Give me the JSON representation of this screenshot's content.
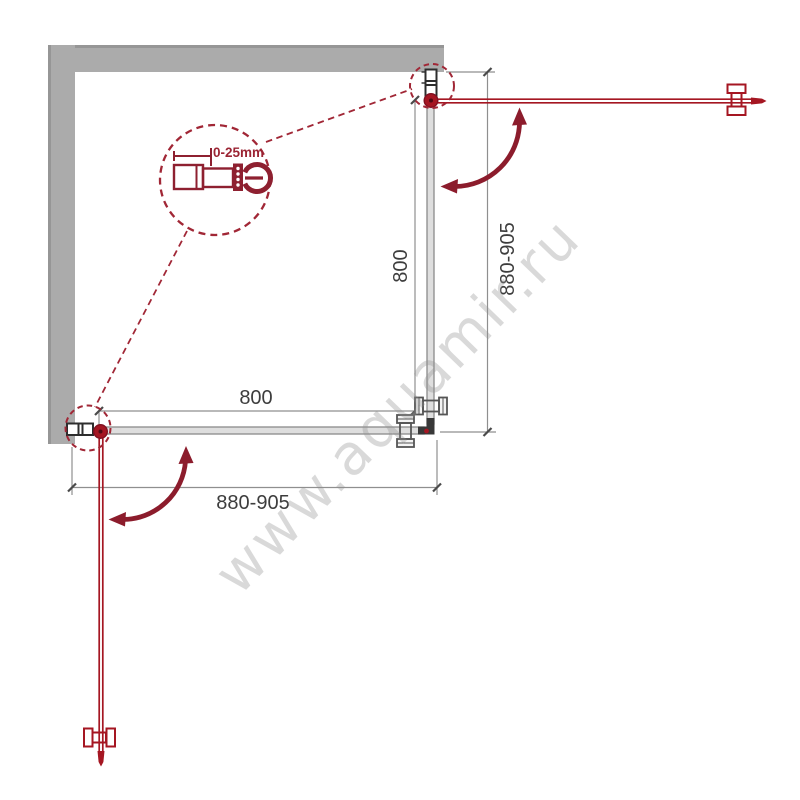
{
  "dimensions": {
    "horizontal": {
      "inner": "800",
      "overall": "880-905"
    },
    "vertical": {
      "inner": "800",
      "overall": "880-905"
    }
  },
  "detail_callout": {
    "adjustment_label": "0-25mm"
  },
  "watermark": {
    "text": "www.aquamir.ru"
  },
  "colors": {
    "wall_gray": "#ababab",
    "glass_gray": "#dedede",
    "door_red": "#a51622",
    "arrow_red": "#8c1c2c",
    "callout_red": "#a12736",
    "profile_dark": "#2d2d2d",
    "dimension_line": "#8f8f8f",
    "dimension_text": "#3d3d3d",
    "watermark_gray": "#d9d9d9"
  }
}
